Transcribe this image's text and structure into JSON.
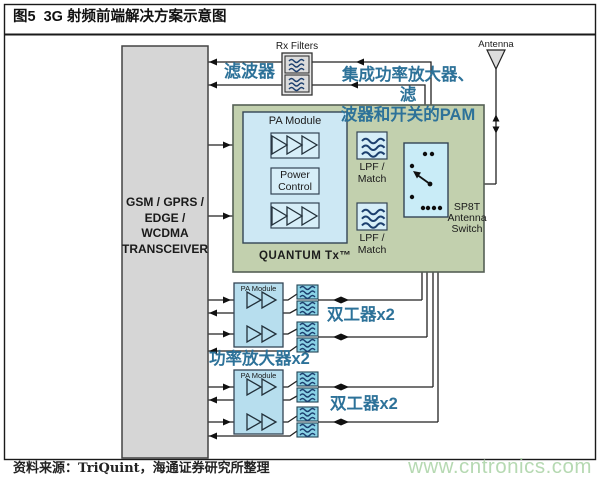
{
  "window": {
    "title": "图5  3G 射频前端解决方案示意图",
    "source": "资料来源：TriQuint，海通证券研究所整理",
    "watermark": "www.cntronics.com"
  },
  "annotations": {
    "rx_filter": "滤波器",
    "pam_line1": "集成功率放大器、滤",
    "pam_line2": "波器和开关的PAM",
    "power_amp": "功率放大器x2",
    "duplexer": "双工器x2"
  },
  "blocks": {
    "transceiver_line1": "GSM / GPRS /",
    "transceiver_line2": "EDGE / WCDMA",
    "transceiver_line3": "TRANSCEIVER",
    "rx_filters": "Rx Filters",
    "antenna": "Antenna",
    "pa_module": "PA Module",
    "power_line1": "Power",
    "power_line2": "Control",
    "lpf_line1": "LPF /",
    "lpf_line2": "Match",
    "quantum": "QUANTUM Tx™",
    "switch_line1": "SP8T",
    "switch_line2": "Antenna",
    "switch_line3": "Switch",
    "pa_module_small": "PA Module"
  },
  "colors": {
    "annotation_blue": "#2d7299",
    "quantum_green": "#c2d0ae",
    "module_blue": "#cde8f4",
    "filter_cyan": "#8ad2e6",
    "transceiver_gray": "#d6d6d6",
    "watermark_green": "#b6d9b2"
  }
}
